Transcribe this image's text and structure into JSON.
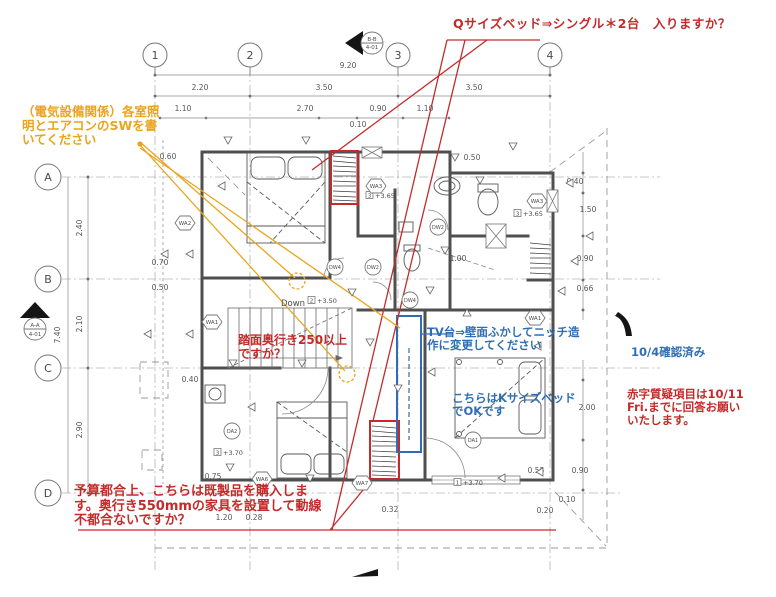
{
  "annotations": {
    "q_bed": {
      "color": "#c32b2b",
      "lines": [
        "Qサイズベッド⇒シングル＊2台　入りますか？"
      ]
    },
    "electrical": {
      "color": "#e9a51c",
      "lines": [
        "（電気設備関係）各室照",
        "明とエアコンのSWを書",
        "いてください"
      ]
    },
    "stair": {
      "color": "#c32b2b",
      "lines": [
        "踏面奥行き250以上",
        "ですか？"
      ]
    },
    "tv": {
      "color": "#2f6eb5",
      "lines": [
        "TV台⇒壁面ふかしてニッチ造",
        "作に変更してください"
      ]
    },
    "kbed": {
      "color": "#2f6eb5",
      "lines": [
        "こちらはKサイズベッド",
        "でOKです"
      ]
    },
    "confirmed": {
      "color": "#2f6eb5",
      "lines": [
        "10/4確認済み"
      ]
    },
    "deadline": {
      "color": "#c32b2b",
      "lines": [
        "赤字質疑項目は10/11",
        "Fri.までに回答お願い",
        "いたします。"
      ]
    },
    "budget": {
      "color": "#c32b2b",
      "lines": [
        "予算都合上、こちらは既製品を購入しま",
        "す。奥行き550mmの家具を設置して動線",
        "不都合ないですか？"
      ]
    }
  },
  "grid": {
    "cols": [
      {
        "label": "1",
        "x": 155
      },
      {
        "label": "2",
        "x": 250
      },
      {
        "label": "3",
        "x": 398
      },
      {
        "label": "4",
        "x": 550
      }
    ],
    "rows": [
      {
        "label": "A",
        "y": 177
      },
      {
        "label": "B",
        "y": 279
      },
      {
        "label": "C",
        "y": 368
      },
      {
        "label": "D",
        "y": 493
      }
    ]
  },
  "dims": [
    {
      "t": "9.20",
      "x": 348,
      "y": 68
    },
    {
      "t": "2.20",
      "x": 200,
      "y": 90
    },
    {
      "t": "3.50",
      "x": 324,
      "y": 90
    },
    {
      "t": "3.50",
      "x": 474,
      "y": 90
    },
    {
      "t": "1.10",
      "x": 183,
      "y": 111
    },
    {
      "t": "2.70",
      "x": 305,
      "y": 111
    },
    {
      "t": "0.90",
      "x": 378,
      "y": 111
    },
    {
      "t": "1.10",
      "x": 425,
      "y": 111
    },
    {
      "t": "0.10",
      "x": 358,
      "y": 127
    },
    {
      "t": "0.50",
      "x": 472,
      "y": 160
    },
    {
      "t": "7.40",
      "x": 60,
      "y": 335,
      "v": 1
    },
    {
      "t": "2.40",
      "x": 82,
      "y": 228,
      "v": 1
    },
    {
      "t": "2.10",
      "x": 82,
      "y": 324,
      "v": 1
    },
    {
      "t": "2.90",
      "x": 82,
      "y": 430,
      "v": 1
    },
    {
      "t": "0.60",
      "x": 168,
      "y": 159
    },
    {
      "t": "0.70",
      "x": 160,
      "y": 265
    },
    {
      "t": "0.50",
      "x": 160,
      "y": 290
    },
    {
      "t": "0.40",
      "x": 190,
      "y": 382
    },
    {
      "t": "0.75",
      "x": 213,
      "y": 479
    },
    {
      "t": "0.40",
      "x": 575,
      "y": 184
    },
    {
      "t": "1.50",
      "x": 588,
      "y": 212
    },
    {
      "t": "0.90",
      "x": 585,
      "y": 261
    },
    {
      "t": "0.66",
      "x": 585,
      "y": 291
    },
    {
      "t": "2.00",
      "x": 587,
      "y": 410
    },
    {
      "t": "0.90",
      "x": 580,
      "y": 473
    },
    {
      "t": "0.55",
      "x": 536,
      "y": 473
    },
    {
      "t": "0.10",
      "x": 567,
      "y": 502
    },
    {
      "t": "0.20",
      "x": 545,
      "y": 513
    },
    {
      "t": "0.32",
      "x": 390,
      "y": 512
    },
    {
      "t": "1.20",
      "x": 224,
      "y": 520
    },
    {
      "t": "0.28",
      "x": 254,
      "y": 520
    }
  ],
  "levels": [
    {
      "n": "3",
      "t": "+3.65",
      "x": 366,
      "y": 198
    },
    {
      "n": "3",
      "t": "+3.65",
      "x": 514,
      "y": 216
    },
    {
      "n": "2",
      "t": "+3.50",
      "x": 308,
      "y": 303
    },
    {
      "n": "3",
      "t": "+3.70",
      "x": 214,
      "y": 455
    },
    {
      "n": "1",
      "t": "+3.70",
      "x": 454,
      "y": 485
    }
  ],
  "wall_tags": [
    {
      "t": "WA2",
      "x": 185,
      "y": 223
    },
    {
      "t": "WA1",
      "x": 212,
      "y": 322
    },
    {
      "t": "WA3",
      "x": 376,
      "y": 186
    },
    {
      "t": "WA3",
      "x": 537,
      "y": 201
    },
    {
      "t": "WA6",
      "x": 262,
      "y": 479
    },
    {
      "t": "WA7",
      "x": 362,
      "y": 483
    },
    {
      "t": "WA1",
      "x": 535,
      "y": 318
    }
  ],
  "door_tags": [
    {
      "t": "DW4",
      "x": 335,
      "y": 267
    },
    {
      "t": "DW2",
      "x": 373,
      "y": 267
    },
    {
      "t": "DW2",
      "x": 438,
      "y": 227
    },
    {
      "t": "DW4",
      "x": 410,
      "y": 300
    },
    {
      "t": "DA2",
      "x": 232,
      "y": 431
    },
    {
      "t": "DA1",
      "x": 473,
      "y": 440
    }
  ],
  "section_marks": [
    {
      "l1": "B-B",
      "l2": "4-01",
      "x": 372,
      "y1": 41,
      "y2": 49
    },
    {
      "l1": "A-A",
      "l2": "4-01",
      "x": 35,
      "y1": 327,
      "y2": 336
    }
  ],
  "misc": {
    "down": "Down",
    "slope": "1.00"
  },
  "symbols": [
    [
      228,
      140,
      "d"
    ],
    [
      306,
      140,
      "d"
    ],
    [
      455,
      157,
      "d"
    ],
    [
      513,
      146,
      "d"
    ],
    [
      222,
      186,
      "l"
    ],
    [
      165,
      254,
      "l"
    ],
    [
      190,
      254,
      "l"
    ],
    [
      148,
      334,
      "l"
    ],
    [
      190,
      334,
      "l"
    ],
    [
      233,
      363,
      "d"
    ],
    [
      302,
      363,
      "d"
    ],
    [
      252,
      407,
      "l"
    ],
    [
      230,
      467,
      "d"
    ],
    [
      310,
      478,
      "d"
    ],
    [
      570,
      183,
      "l"
    ],
    [
      590,
      236,
      "l"
    ],
    [
      575,
      261,
      "l"
    ],
    [
      562,
      291,
      "l"
    ],
    [
      540,
      472,
      "l"
    ],
    [
      502,
      478,
      "l"
    ],
    [
      445,
      250,
      "d"
    ],
    [
      352,
      292,
      "d"
    ],
    [
      370,
      342,
      "d"
    ],
    [
      398,
      388,
      "d"
    ],
    [
      432,
      372,
      "l"
    ],
    [
      538,
      346,
      "l"
    ],
    [
      467,
      313,
      "u"
    ],
    [
      480,
      180,
      "d"
    ],
    [
      430,
      290,
      "d"
    ]
  ],
  "highlight_colors": {
    "question_red": "#c32b2b",
    "note_blue": "#2f6eb5",
    "leader_orange": "#e9a51c"
  }
}
